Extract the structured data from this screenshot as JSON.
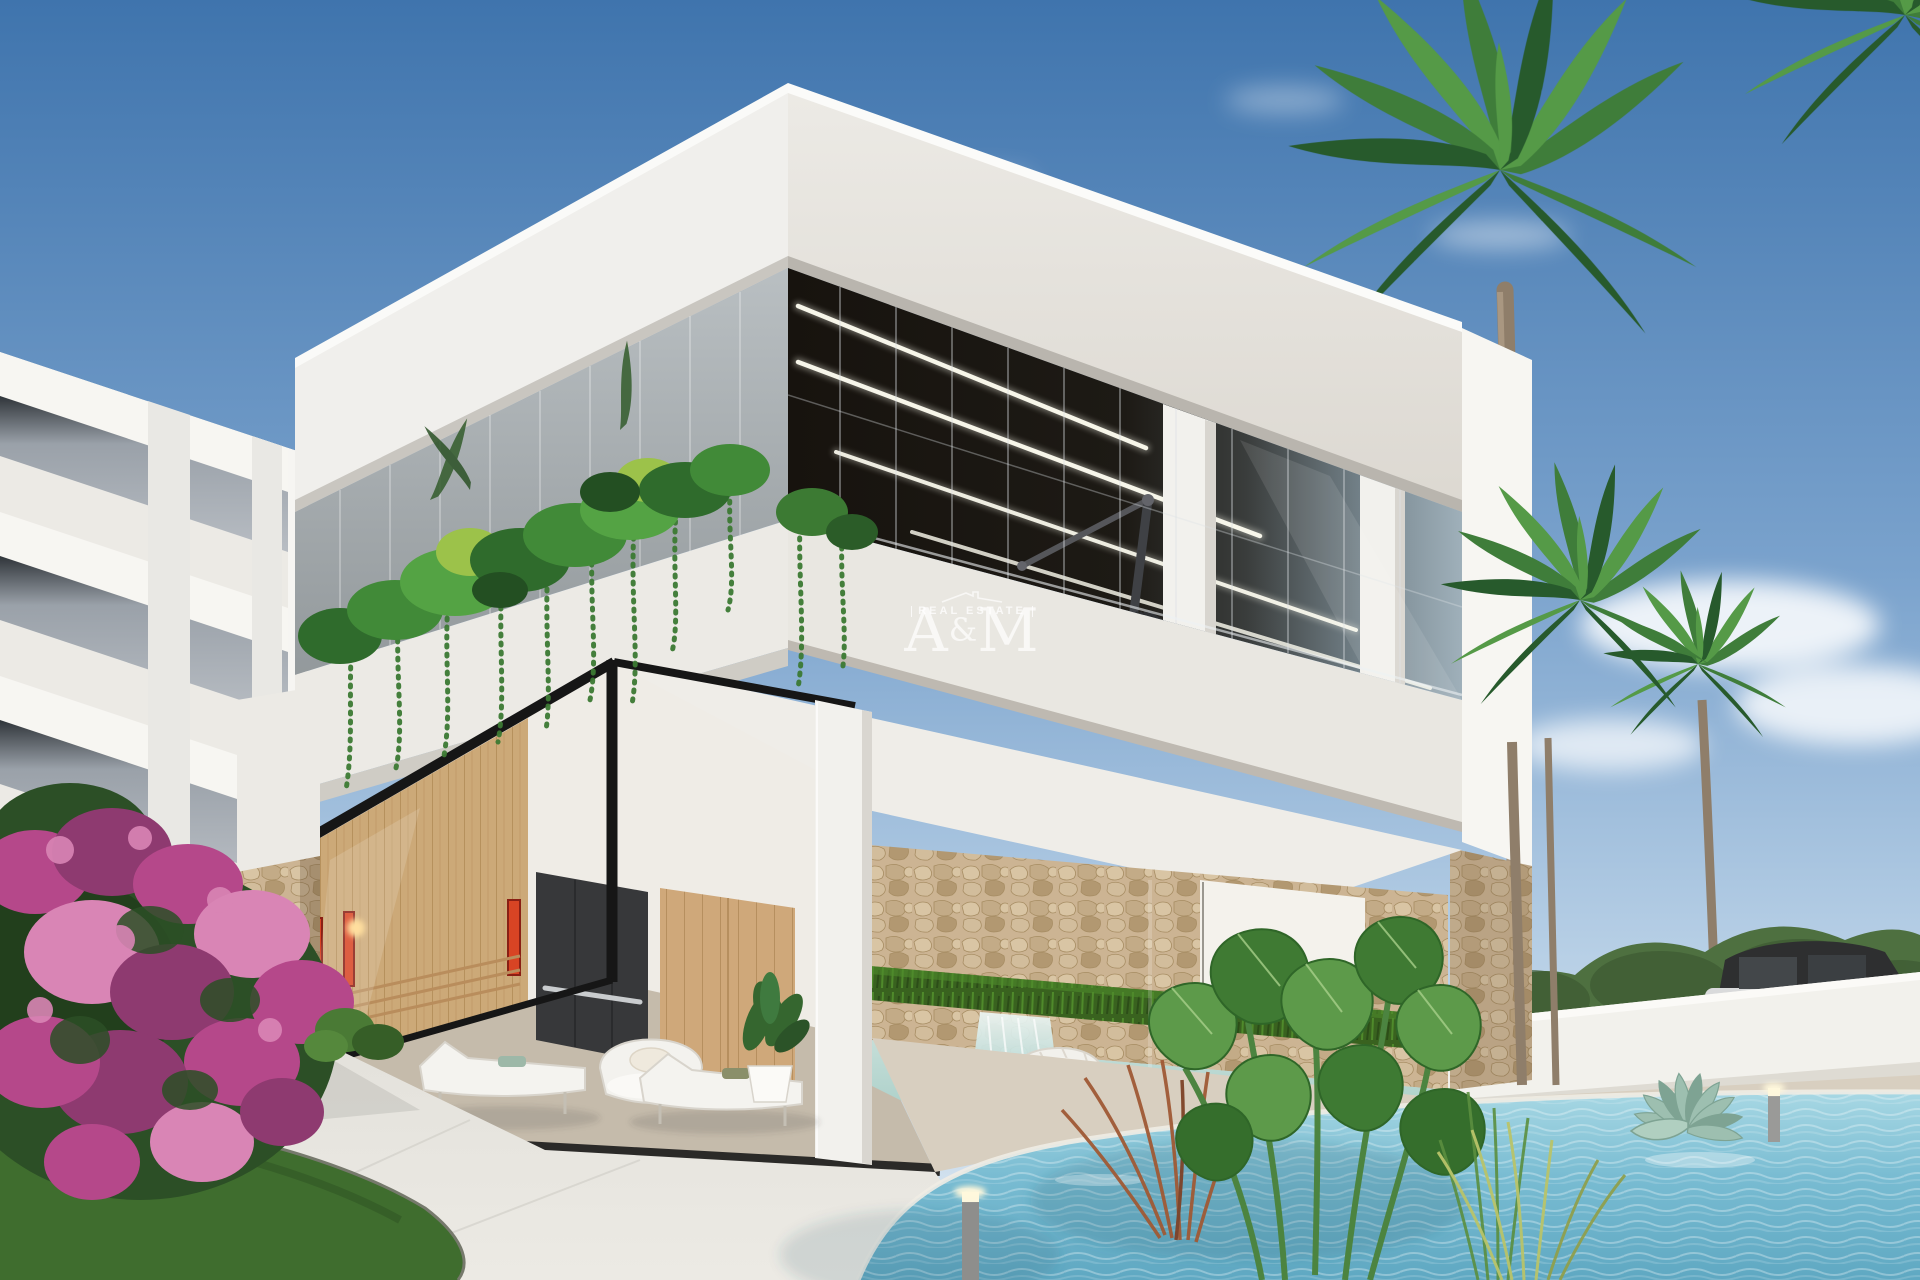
{
  "watermark": {
    "tagline": "REAL ESTATE",
    "brand_a": "A",
    "brand_amp": "&",
    "brand_m": "M"
  },
  "colors": {
    "sky_top": "#3f74ad",
    "sky_mid": "#7ba3cd",
    "sky_low": "#b8d0e6",
    "sky_horizon": "#dbe7f1",
    "cloud": "#ffffff",
    "white_lit": "#f7f6f2",
    "white_face": "#eceae5",
    "white_shade": "#dfdcd6",
    "soffit": "#cfccc5",
    "glass_dark": "#17130e",
    "glass_mid": "#3a3d3c",
    "glass_sky": "#9fb0ba",
    "glass_left_hi": "#b9bfc2",
    "glass_left_lo": "#93999c",
    "mullion": "#dde2e5",
    "led": "#fffef2",
    "column_white": "#f2f1ed",
    "frame_black": "#161616",
    "stone_base": "#ccb493",
    "stone_hi": "#d9c5a4",
    "stone_lo": "#b29871",
    "stone_line": "#a78d63",
    "grass_dark": "#2c4d18",
    "grass_mid": "#39621f",
    "grass_hi": "#4f8a2b",
    "wood_sauna": "#d8b585",
    "wood_sauna_line": "#bf9a66",
    "wood_door": "#cfa87a",
    "wood_door_line": "#b68f5f",
    "cabinet_dark": "#37383a",
    "heater_red": "#d84424",
    "heater_deep": "#8a1f14",
    "lamp_glow": "#ffd98f",
    "interior_wall": "#efece6",
    "interior_floor": "#d6cdbd",
    "deck": "#d8cfc0",
    "pavement": "#e2e0da",
    "pavement_lo": "#cfcdc6",
    "lawn": "#3f6d2e",
    "lawn_dark": "#2e5222",
    "bougie_main": "#b5488a",
    "bougie_light": "#d985b5",
    "bougie_deep": "#8e3a70",
    "bush_leaf": "#2c4f26",
    "leaf_green": "#3f7a33",
    "leaf_light": "#5d9a4a",
    "palm_dark": "#275a2c",
    "palm_mid": "#3f7d3a",
    "palm_light": "#559a47",
    "trunk": "#8f7e6a",
    "trunk_hi": "#b3a28c",
    "hedge": "#4e7040",
    "hedge_dark": "#3d5a33",
    "wall_white": "#f2f1ec",
    "car_dark": "#2e2f30",
    "car_silver": "#d9dadb",
    "taillight": "#c0392b",
    "pool_light": "#a8d8e4",
    "pool_main": "#79bcd2",
    "pool_deep": "#5fa8c2",
    "indoor_pool": "#9fc9c2",
    "indoor_pool_light": "#c5ded8",
    "waterfall_hi": "#eef7f5",
    "waterfall_lo": "#8fc6c4",
    "agave": "#9dbfb0",
    "agave_dark": "#7ea393",
    "red_grass": "#a05a35",
    "reed_green": "#5b8f3f",
    "dry_grass": "#b9c46a",
    "watermark": "rgba(255,255,255,0.82)"
  }
}
